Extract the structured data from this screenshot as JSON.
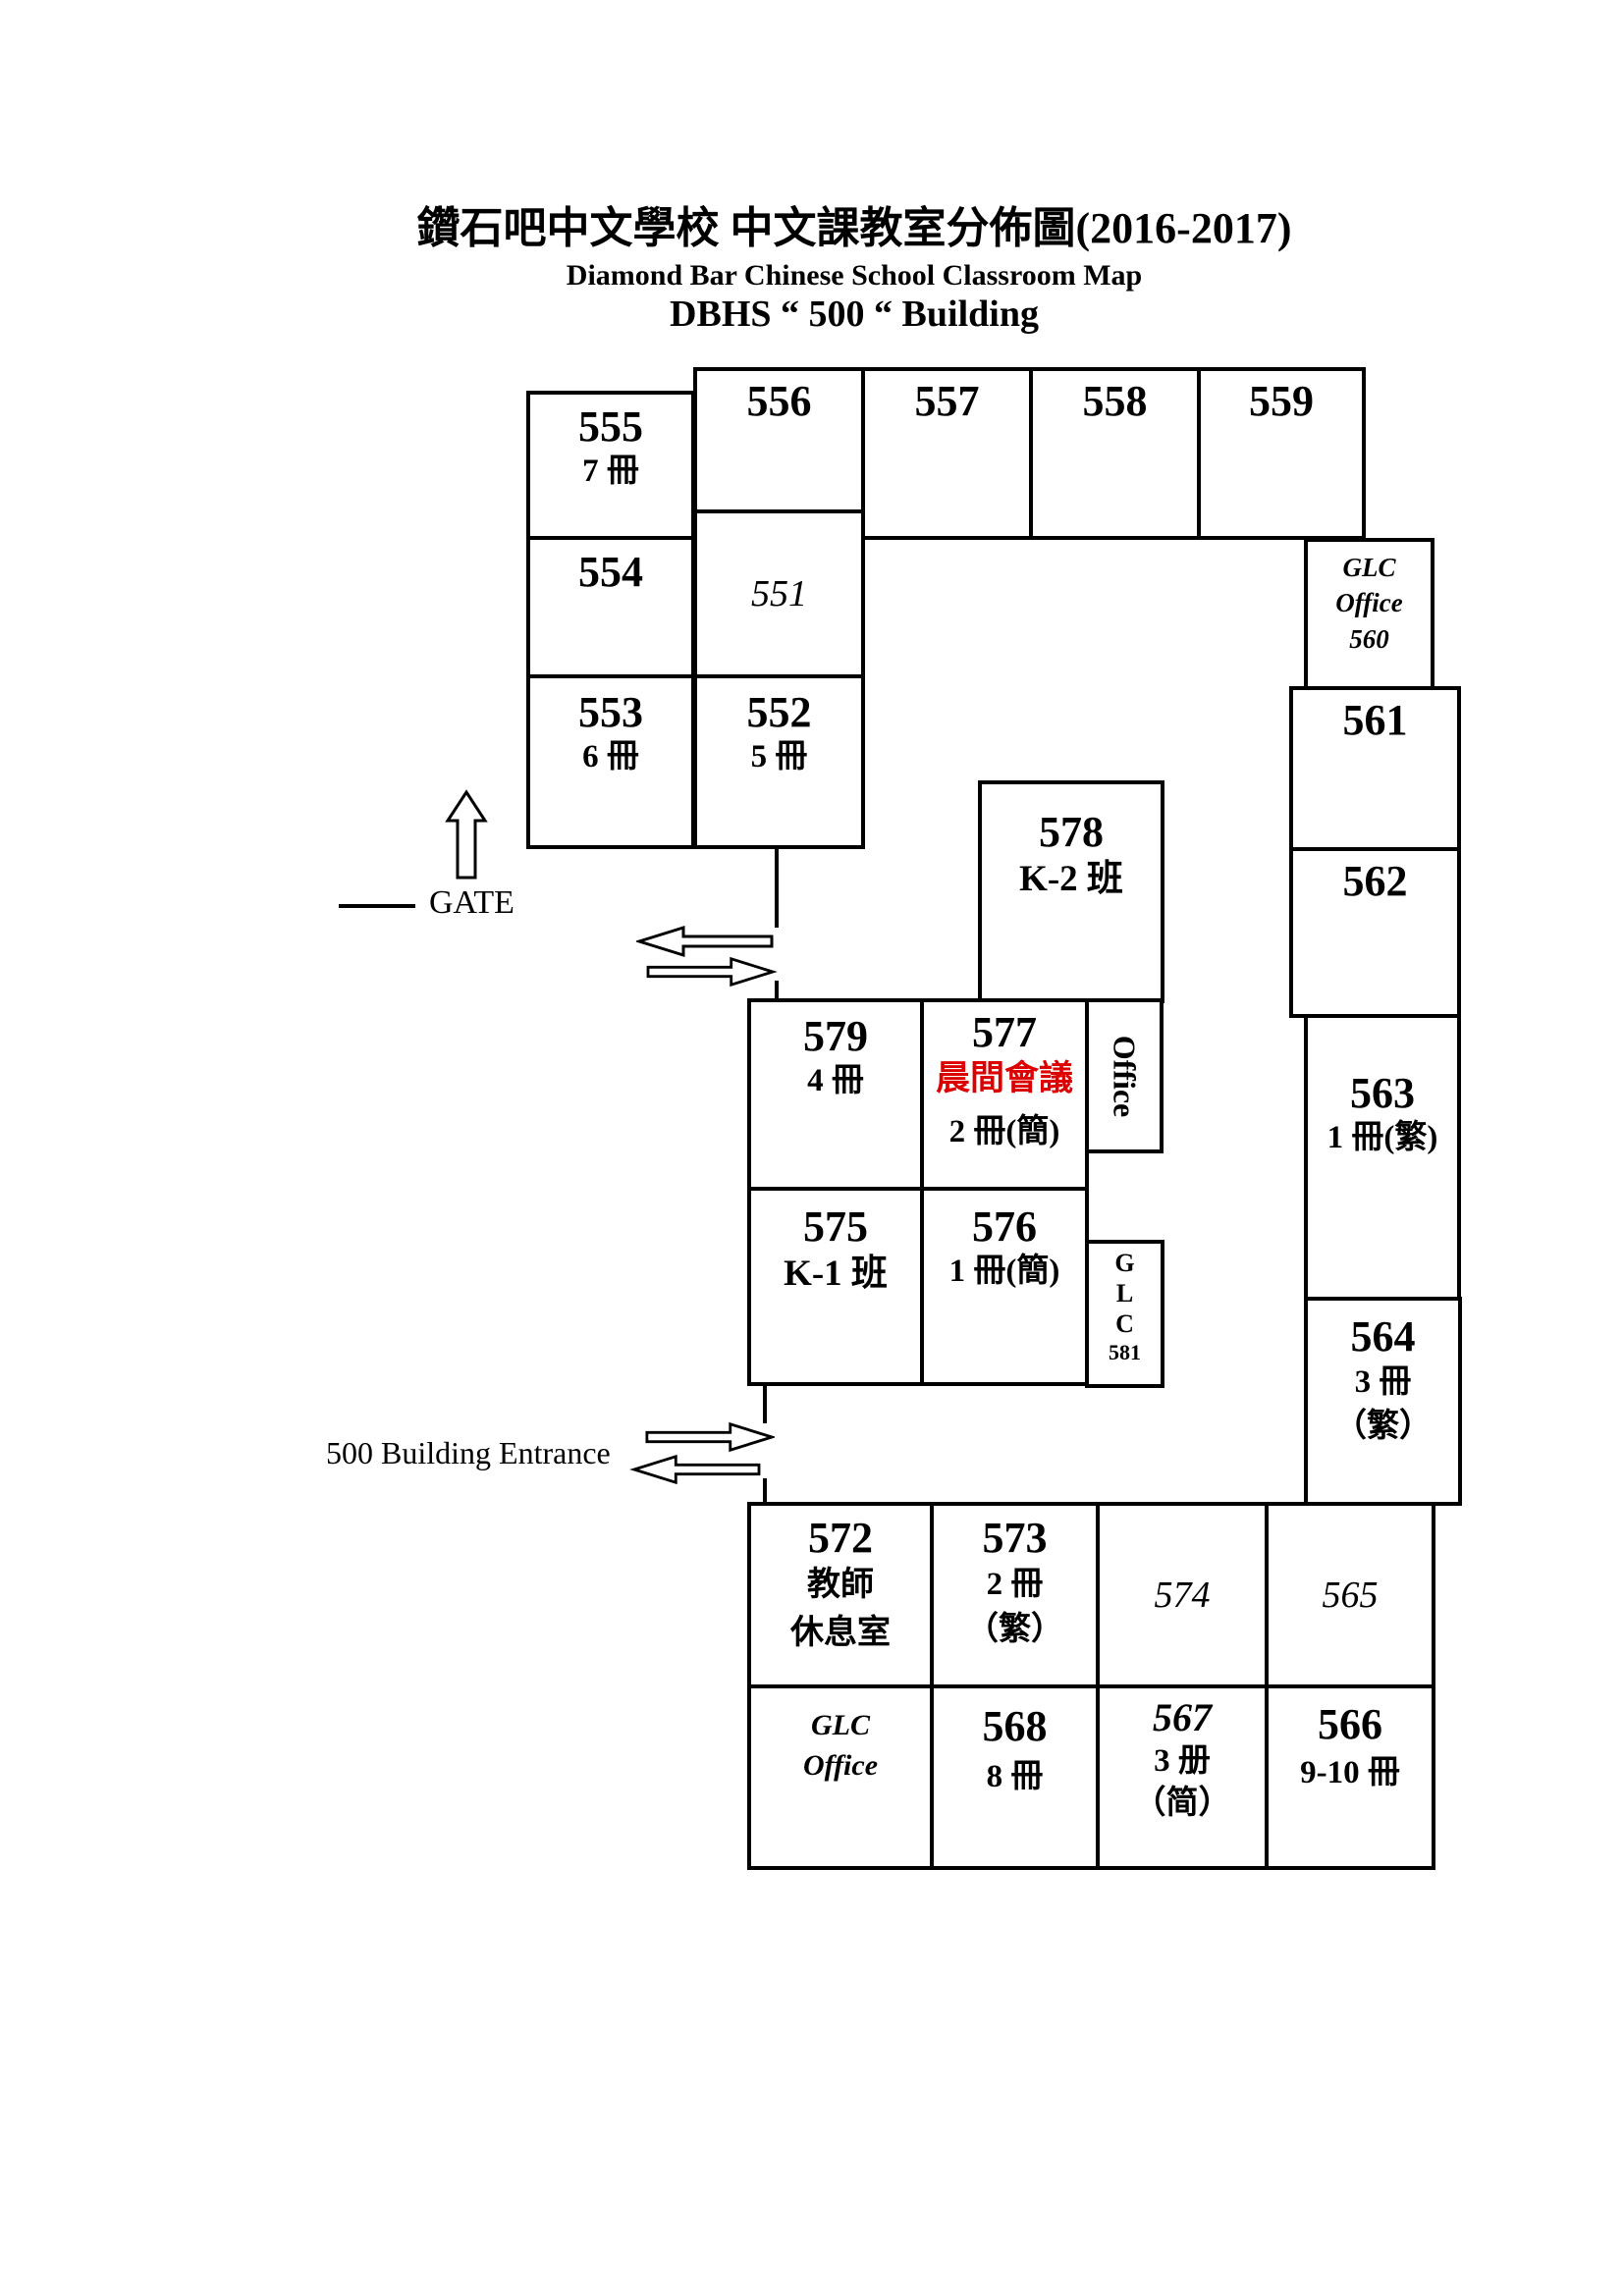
{
  "title": {
    "line1": "鑽石吧中文學校 中文課教室分佈圖(2016-2017)",
    "line2": "Diamond Bar Chinese School Classroom Map",
    "line3": "DBHS “ 500 “ Building"
  },
  "labels": {
    "gate": "GATE",
    "entrance": "500 Building Entrance"
  },
  "colors": {
    "ink": "#000000",
    "highlight_red": "#dd0000",
    "background": "#ffffff"
  },
  "rooms": {
    "r555": {
      "num": "555",
      "sub1": "7 冊"
    },
    "r556": {
      "num": "556"
    },
    "r557": {
      "num": "557"
    },
    "r558": {
      "num": "558"
    },
    "r559": {
      "num": "559"
    },
    "r554": {
      "num": "554"
    },
    "r551": {
      "num": "551"
    },
    "r553": {
      "num": "553",
      "sub1": "6 冊"
    },
    "r552": {
      "num": "552",
      "sub1": "5 冊"
    },
    "r560": {
      "line1": "GLC",
      "line2": "Office",
      "line3": "560"
    },
    "r561": {
      "num": "561"
    },
    "r562": {
      "num": "562"
    },
    "r563": {
      "num": "563",
      "sub1": "1 冊(繁)"
    },
    "r564": {
      "num": "564",
      "sub1": "3 冊",
      "sub2": "（繁）"
    },
    "r578": {
      "num": "578",
      "sub1": "K-2 班"
    },
    "r579": {
      "num": "579",
      "sub1": "4 冊"
    },
    "r577": {
      "num": "577",
      "red": "晨間會議",
      "sub1": "2 冊(簡)"
    },
    "office": {
      "label": "Office"
    },
    "r575": {
      "num": "575",
      "sub1": "K-1 班"
    },
    "r576": {
      "num": "576",
      "sub1": "1 冊(簡)"
    },
    "glc581": {
      "line1": "G",
      "line2": "L",
      "line3": "C",
      "line4": "581"
    },
    "r572": {
      "num": "572",
      "sub1": "教師",
      "sub2": "休息室"
    },
    "r573": {
      "num": "573",
      "sub1": "2 冊",
      "sub2": "（繁）"
    },
    "r574": {
      "num": "574"
    },
    "r565": {
      "num": "565"
    },
    "glc_office_bottom": {
      "line1": "GLC",
      "line2": "Office"
    },
    "r568": {
      "num": "568",
      "sub1": "8 冊"
    },
    "r567": {
      "num": "567",
      "sub1": "3 册",
      "sub2": "（简）"
    },
    "r566": {
      "num": "566",
      "sub1": "9-10 冊"
    }
  }
}
